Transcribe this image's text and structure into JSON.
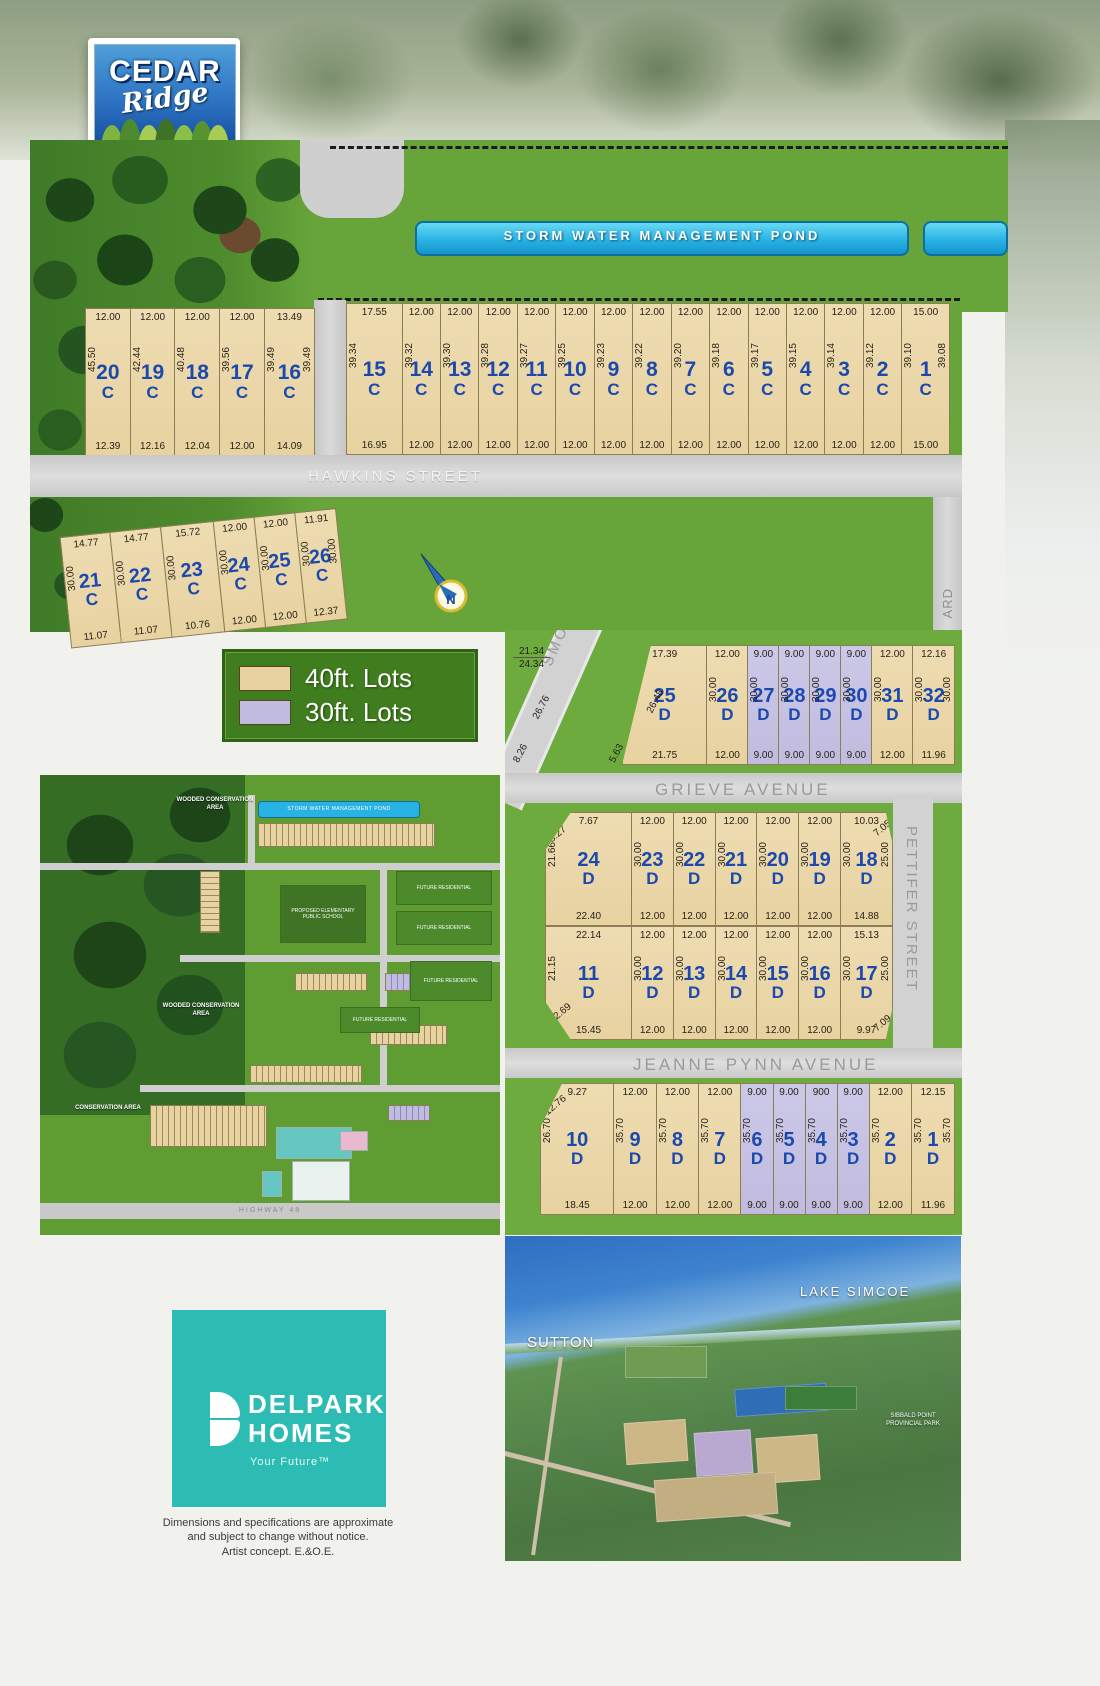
{
  "logo": {
    "top": "CEDAR",
    "script": "Ridge",
    "bottom": "IN SUTTON"
  },
  "labels": {
    "wooded_area": "WOODED CONSERVATION AREA",
    "pond": "STORM WATER MANAGEMENT POND",
    "hawkins": "HAWKINS STREET",
    "grieve": "GRIEVE AVENUE",
    "jeanne": "JEANNE PYNN AVENUE",
    "pettifer": "PETTIFER STREET",
    "smockum": "SMOCKUM BOULEVARD",
    "boulevard_partial": "ARD",
    "north": "N"
  },
  "legend": {
    "items": [
      {
        "label": "40ft. Lots",
        "color": "#e7d2a0"
      },
      {
        "label": "30ft. Lots",
        "color": "#c1bcdf"
      }
    ]
  },
  "colors": {
    "tan": "#e7d2a0",
    "purple": "#c1bcdf",
    "lot_number_blue": "#1c49ad",
    "pond_blue": "#29b3e4",
    "legend_green": "#3f7d1e",
    "delpark_teal": "#2dbcb3"
  },
  "blocks": {
    "c_west": {
      "lots": [
        {
          "id": "20",
          "ph": "C",
          "top": "12.00",
          "side": "45.50",
          "bottom": "12.39"
        },
        {
          "id": "19",
          "ph": "C",
          "top": "12.00",
          "side": "42.44",
          "bottom": "12.16"
        },
        {
          "id": "18",
          "ph": "C",
          "top": "12.00",
          "side": "40.48",
          "bottom": "12.04"
        },
        {
          "id": "17",
          "ph": "C",
          "top": "12.00",
          "side": "39.56",
          "bottom": "12.00"
        },
        {
          "id": "16",
          "ph": "C",
          "top": "13.49",
          "side": "39.49",
          "bottom": "14.09",
          "side_right": "39.49",
          "w": 13.5
        }
      ]
    },
    "c_north": {
      "lots": [
        {
          "id": "15",
          "ph": "C",
          "top": "17.55",
          "side": "39.34",
          "bottom": "16.95",
          "w": 17.5
        },
        {
          "id": "14",
          "ph": "C",
          "top": "12.00",
          "side": "39.32",
          "bottom": "12.00"
        },
        {
          "id": "13",
          "ph": "C",
          "top": "12.00",
          "side": "39.30",
          "bottom": "12.00"
        },
        {
          "id": "12",
          "ph": "C",
          "top": "12.00",
          "side": "39.28",
          "bottom": "12.00"
        },
        {
          "id": "11",
          "ph": "C",
          "top": "12.00",
          "side": "39.27",
          "bottom": "12.00"
        },
        {
          "id": "10",
          "ph": "C",
          "top": "12.00",
          "side": "39.25",
          "bottom": "12.00"
        },
        {
          "id": "9",
          "ph": "C",
          "top": "12.00",
          "side": "39.23",
          "bottom": "12.00"
        },
        {
          "id": "8",
          "ph": "C",
          "top": "12.00",
          "side": "39.22",
          "bottom": "12.00"
        },
        {
          "id": "7",
          "ph": "C",
          "top": "12.00",
          "side": "39.20",
          "bottom": "12.00"
        },
        {
          "id": "6",
          "ph": "C",
          "top": "12.00",
          "side": "39.18",
          "bottom": "12.00"
        },
        {
          "id": "5",
          "ph": "C",
          "top": "12.00",
          "side": "39.17",
          "bottom": "12.00"
        },
        {
          "id": "4",
          "ph": "C",
          "top": "12.00",
          "side": "39.15",
          "bottom": "12.00"
        },
        {
          "id": "3",
          "ph": "C",
          "top": "12.00",
          "side": "39.14",
          "bottom": "12.00"
        },
        {
          "id": "2",
          "ph": "C",
          "top": "12.00",
          "side": "39.12",
          "bottom": "12.00"
        },
        {
          "id": "1",
          "ph": "C",
          "top": "15.00",
          "side": "39.10",
          "bottom": "15.00",
          "side_right": "39.08",
          "w": 15
        }
      ]
    },
    "c_south": {
      "lots": [
        {
          "id": "21",
          "ph": "C",
          "top": "14.77",
          "side": "30.00",
          "bottom": "11.07",
          "w": 14.8
        },
        {
          "id": "22",
          "ph": "C",
          "top": "14.77",
          "side": "30.00",
          "bottom": "11.07",
          "w": 14.8
        },
        {
          "id": "23",
          "ph": "C",
          "top": "15.72",
          "side": "30.00",
          "bottom": "10.76",
          "w": 15.7
        },
        {
          "id": "24",
          "ph": "C",
          "top": "12.00",
          "side": "30.00",
          "bottom": "12.00"
        },
        {
          "id": "25",
          "ph": "C",
          "top": "12.00",
          "side": "30.00",
          "bottom": "12.00"
        },
        {
          "id": "26",
          "ph": "C",
          "top": "11.91",
          "side": "30.00",
          "bottom": "12.37",
          "side_right": "30.00"
        }
      ]
    },
    "d_north": {
      "extras": {
        "c1": "21.34",
        "c2": "24.34",
        "road1": "26.76",
        "road2": "8.26",
        "road3": "5.63"
      },
      "lots": [
        {
          "id": "25",
          "ph": "D",
          "top": "17.39",
          "bottom": "21.75",
          "diag": "26.48",
          "diag_pos": "diag-side",
          "shape": "cut-tl-full",
          "w": 25
        },
        {
          "id": "26",
          "ph": "D",
          "top": "12.00",
          "side": "30.00",
          "bottom": "12.00"
        },
        {
          "id": "27",
          "ph": "D",
          "top": "9.00",
          "side": "30.00",
          "bottom": "9.00",
          "fill": "purple",
          "w": 9
        },
        {
          "id": "28",
          "ph": "D",
          "top": "9.00",
          "side": "30.00",
          "bottom": "9.00",
          "fill": "purple",
          "w": 9
        },
        {
          "id": "29",
          "ph": "D",
          "top": "9.00",
          "side": "30.00",
          "bottom": "9.00",
          "fill": "purple",
          "w": 9
        },
        {
          "id": "30",
          "ph": "D",
          "top": "9.00",
          "side": "30.00",
          "bottom": "9.00",
          "fill": "purple",
          "w": 9
        },
        {
          "id": "31",
          "ph": "D",
          "top": "12.00",
          "side": "30.00",
          "bottom": "12.00"
        },
        {
          "id": "32",
          "ph": "D",
          "top": "12.16",
          "side": "30.00",
          "bottom": "11.96",
          "side_right": "30.00",
          "w": 12.2
        }
      ]
    },
    "d_mid_north": {
      "lots": [
        {
          "id": "24",
          "ph": "D",
          "top": "7.67",
          "diag": "8.27",
          "diag_pos": "diag-tl",
          "side": "21.66",
          "bottom": "22.40",
          "shape": "cut-tl",
          "w": 25
        },
        {
          "id": "23",
          "ph": "D",
          "top": "12.00",
          "side": "30.00",
          "bottom": "12.00"
        },
        {
          "id": "22",
          "ph": "D",
          "top": "12.00",
          "side": "30.00",
          "bottom": "12.00"
        },
        {
          "id": "21",
          "ph": "D",
          "top": "12.00",
          "side": "30.00",
          "bottom": "12.00"
        },
        {
          "id": "20",
          "ph": "D",
          "top": "12.00",
          "side": "30.00",
          "bottom": "12.00"
        },
        {
          "id": "19",
          "ph": "D",
          "top": "12.00",
          "side": "30.00",
          "bottom": "12.00"
        },
        {
          "id": "18",
          "ph": "D",
          "top": "10.03",
          "diag": "7.05",
          "diag_pos": "diag-tr",
          "side": "30.00",
          "side_right": "25.00",
          "bottom": "14.88",
          "shape": "cut-tr",
          "w": 15
        }
      ]
    },
    "d_mid_south": {
      "lots": [
        {
          "id": "11",
          "ph": "D",
          "top": "22.14",
          "diag": "12.69",
          "diag_pos": "diag-bl",
          "side": "21.15",
          "bottom": "15.45",
          "shape": "cut-bl",
          "w": 25
        },
        {
          "id": "12",
          "ph": "D",
          "top": "12.00",
          "side": "30.00",
          "bottom": "12.00"
        },
        {
          "id": "13",
          "ph": "D",
          "top": "12.00",
          "side": "30.00",
          "bottom": "12.00"
        },
        {
          "id": "14",
          "ph": "D",
          "top": "12.00",
          "side": "30.00",
          "bottom": "12.00"
        },
        {
          "id": "15",
          "ph": "D",
          "top": "12.00",
          "side": "30.00",
          "bottom": "12.00"
        },
        {
          "id": "16",
          "ph": "D",
          "top": "12.00",
          "side": "30.00",
          "bottom": "12.00"
        },
        {
          "id": "17",
          "ph": "D",
          "top": "15.13",
          "diag": "7.09",
          "diag_pos": "diag-br",
          "side": "30.00",
          "side_right": "25.00",
          "bottom": "9.97",
          "shape": "cut-br",
          "w": 15
        }
      ]
    },
    "d_south": {
      "lots": [
        {
          "id": "10",
          "ph": "D",
          "top": "9.27",
          "diag": "12.76",
          "diag_pos": "diag-tl",
          "side": "26.70",
          "bottom": "18.45",
          "shape": "cut-tl",
          "w": 21
        },
        {
          "id": "9",
          "ph": "D",
          "top": "12.00",
          "side": "35.70",
          "bottom": "12.00"
        },
        {
          "id": "8",
          "ph": "D",
          "top": "12.00",
          "side": "35.70",
          "bottom": "12.00"
        },
        {
          "id": "7",
          "ph": "D",
          "top": "12.00",
          "side": "35.70",
          "bottom": "12.00"
        },
        {
          "id": "6",
          "ph": "D",
          "top": "9.00",
          "side": "35.70",
          "bottom": "9.00",
          "fill": "purple",
          "w": 9
        },
        {
          "id": "5",
          "ph": "D",
          "top": "9.00",
          "side": "35.70",
          "bottom": "9.00",
          "fill": "purple",
          "w": 9
        },
        {
          "id": "4",
          "ph": "D",
          "top": "900",
          "side": "35.70",
          "bottom": "9.00",
          "fill": "purple",
          "w": 9
        },
        {
          "id": "3",
          "ph": "D",
          "top": "9.00",
          "side": "35.70",
          "bottom": "9.00",
          "fill": "purple",
          "w": 9
        },
        {
          "id": "2",
          "ph": "D",
          "top": "12.00",
          "side": "35.70",
          "bottom": "12.00"
        },
        {
          "id": "1",
          "ph": "D",
          "top": "12.15",
          "side": "35.70",
          "bottom": "11.96",
          "side_right": "35.70",
          "w": 12.2
        }
      ]
    }
  },
  "minimap": {
    "pond": "STORM WATER MANAGEMENT POND",
    "wooded_top": "WOODED CONSERVATION AREA",
    "wooded_mid": "WOODED CONSERVATION AREA",
    "conservation": "CONSERVATION AREA",
    "future1": "FUTURE RESIDENTIAL",
    "future2": "FUTURE RESIDENTIAL",
    "future3": "FUTURE RESIDENTIAL",
    "future4": "FUTURE RESIDENTIAL",
    "school": "PROPOSED ELEMENTARY PUBLIC SCHOOL",
    "highway": "HIGHWAY 48"
  },
  "aerial": {
    "lake": "LAKE SIMCOE",
    "town": "SUTTON",
    "park": "SIBBALD POINT PROVINCIAL PARK"
  },
  "delpark": {
    "line1": "DELPARK",
    "line2": "HOMES",
    "tagline": "Your Future™"
  },
  "disclaimer": {
    "line1": "Dimensions and specifications are approximate",
    "line2": "and subject to change without notice.",
    "line3": "Artist concept. E.&O.E."
  }
}
